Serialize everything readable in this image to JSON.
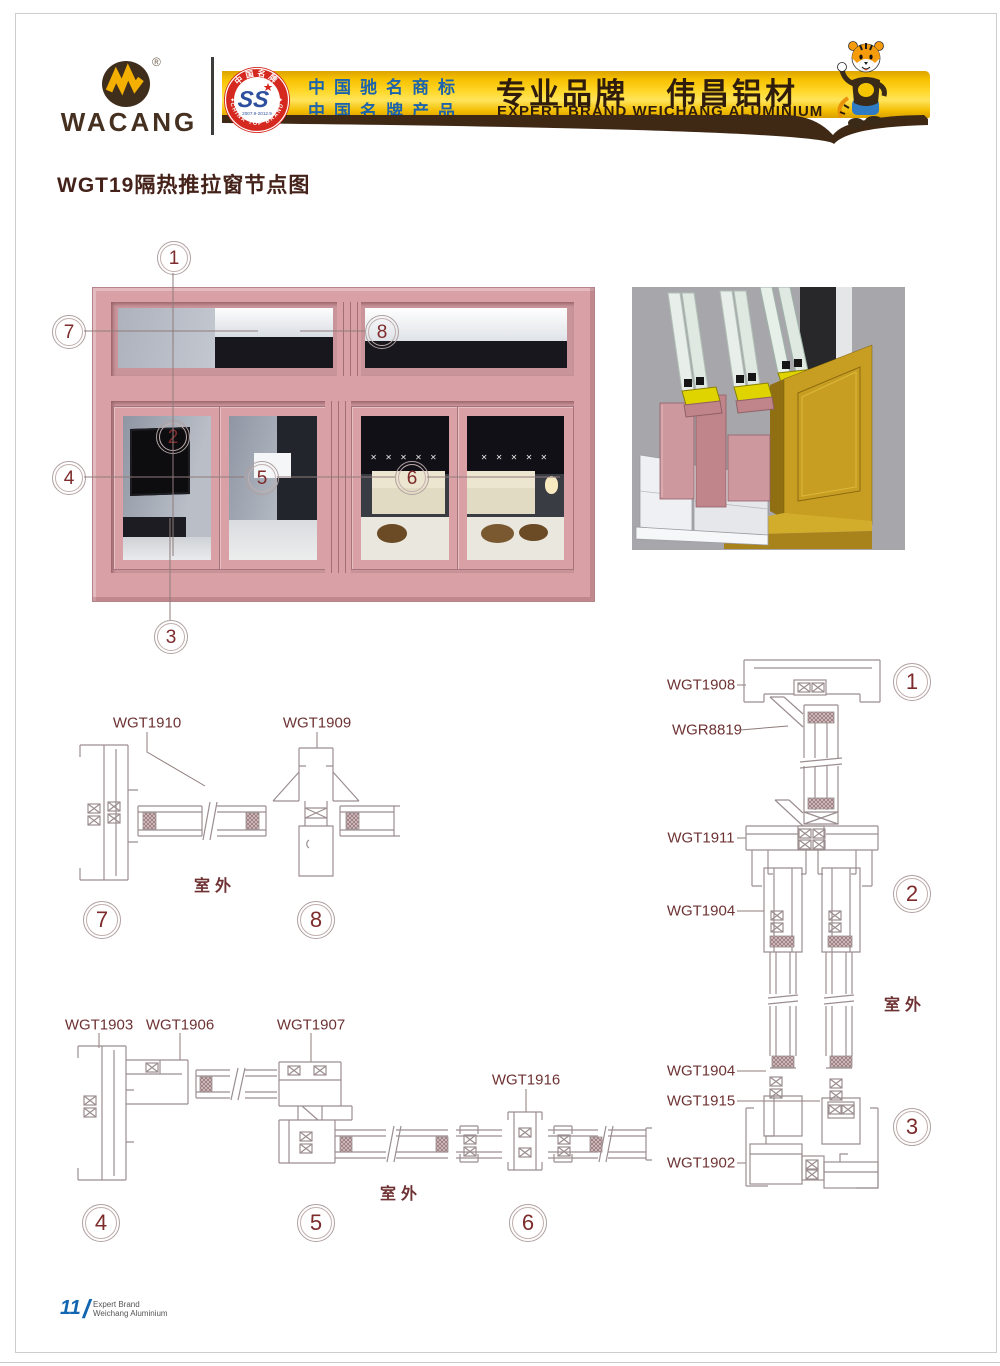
{
  "header": {
    "brand": "WACANG",
    "reg_mark": "®",
    "badge": {
      "top_text": "中国名牌",
      "bottom_text": "CHINA TOP BRAND",
      "center_mark": "SS",
      "dates": "2007.9-2012.9"
    },
    "claim_line1": "中国驰名商标",
    "claim_line2": "中国名牌产品",
    "slogan_cn": "专业品牌",
    "brand_cn": "伟昌铝材",
    "slogan_en": "EXPERT BRAND WEICHANG ALUMINIUM",
    "colors": {
      "banner_gold": "#f7c100",
      "banner_brown": "#3f2814",
      "claim_blue": "#1b64ad",
      "badge_red": "#d5281e"
    }
  },
  "page_title": "WGT19隔热推拉窗节点图",
  "elevation": {
    "callouts": [
      {
        "num": "1"
      },
      {
        "num": "2"
      },
      {
        "num": "3"
      },
      {
        "num": "4"
      },
      {
        "num": "5"
      },
      {
        "num": "6"
      },
      {
        "num": "7"
      },
      {
        "num": "8"
      }
    ],
    "deco_marks": "✕ ✕ ✕ ✕ ✕"
  },
  "sections": {
    "outdoor_label": "室外",
    "top_left": {
      "labels": [
        {
          "code": "WGT1910"
        },
        {
          "code": "WGT1909"
        }
      ],
      "callouts": [
        {
          "num": "7"
        },
        {
          "num": "8"
        }
      ]
    },
    "bottom_left": {
      "labels": [
        {
          "code": "WGT1903"
        },
        {
          "code": "WGT1906"
        },
        {
          "code": "WGT1907"
        },
        {
          "code": "WGT1916"
        }
      ],
      "callouts": [
        {
          "num": "4"
        },
        {
          "num": "5"
        },
        {
          "num": "6"
        }
      ]
    },
    "right": {
      "labels": [
        {
          "code": "WGT1908"
        },
        {
          "code": "WGR8819"
        },
        {
          "code": "WGT1911"
        },
        {
          "code": "WGT1904"
        },
        {
          "code": "WGT1904"
        },
        {
          "code": "WGT1915"
        },
        {
          "code": "WGT1902"
        }
      ],
      "callouts": [
        {
          "num": "1"
        },
        {
          "num": "2"
        },
        {
          "num": "3"
        }
      ]
    }
  },
  "footer": {
    "page_number": "11",
    "slash": "/",
    "line1": "Expert Brand",
    "line2": "Weichang Aluminium"
  }
}
